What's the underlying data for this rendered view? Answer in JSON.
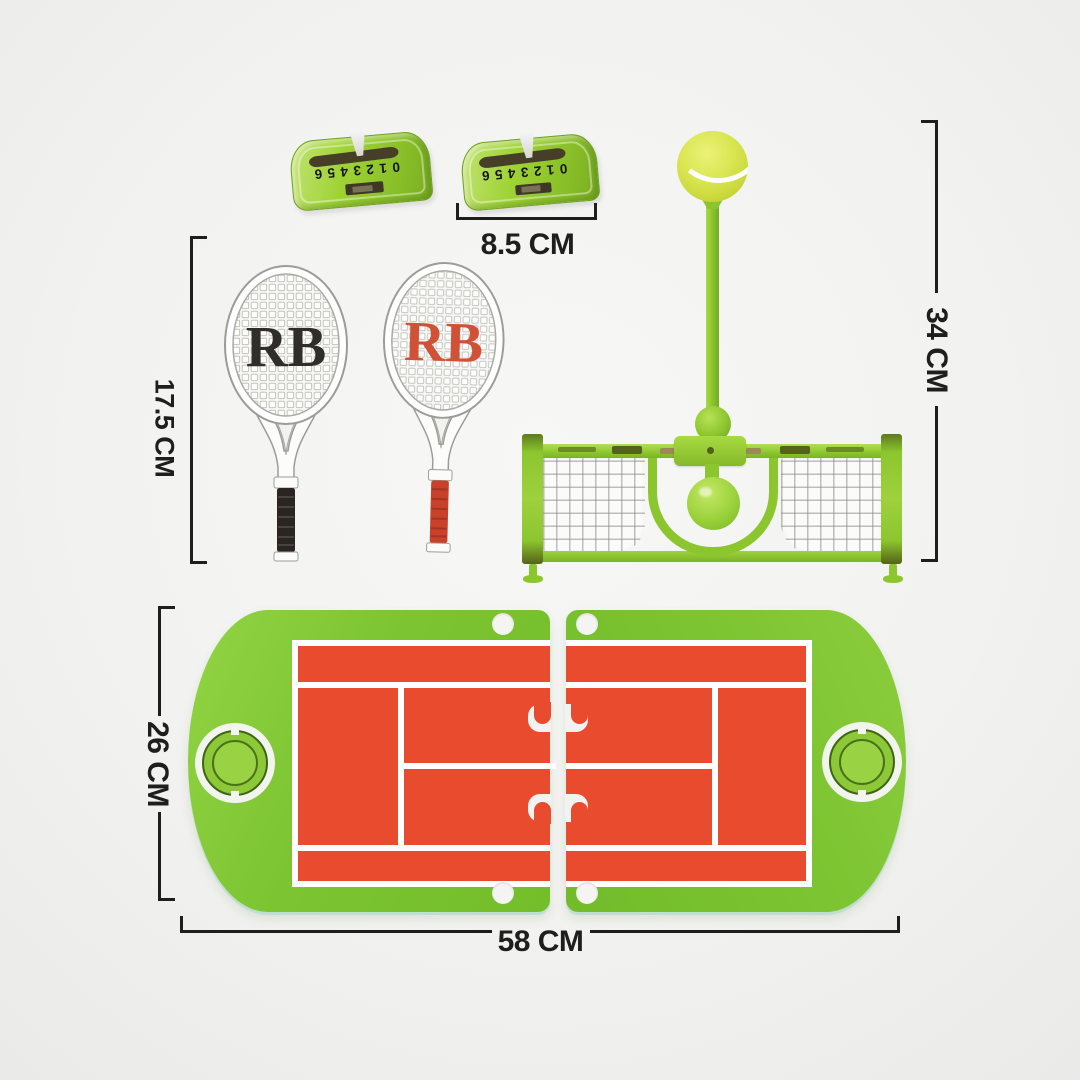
{
  "photo": {
    "description": "toy tennis trainer set with dimensions",
    "counters": {
      "left": {
        "digits": "0123456"
      },
      "right": {
        "digits": "0123456"
      }
    },
    "rackets": {
      "left": {
        "logo": "RB",
        "logo_color": "#312d2b",
        "grip_color": "#2b2521"
      },
      "right": {
        "logo": "RB",
        "logo_color": "#d05136",
        "grip_color": "#c9402b"
      }
    },
    "colors": {
      "board_green": "#7cc431",
      "toy_green": "#8cc62e",
      "court_red": "#e84b2e",
      "ball_yellow": "#dbe755",
      "net_white": "#fbfbf9",
      "dimension_ink": "#1e1e1c",
      "background": "#f2f2f0"
    }
  },
  "dimensions": {
    "counter_width": {
      "label": "8.5 CM"
    },
    "racket_length": {
      "label": "17.5 CM"
    },
    "trainer_height": {
      "label": "34 CM"
    },
    "board_depth": {
      "label": "26 CM"
    },
    "board_width": {
      "label": "58 CM"
    }
  }
}
